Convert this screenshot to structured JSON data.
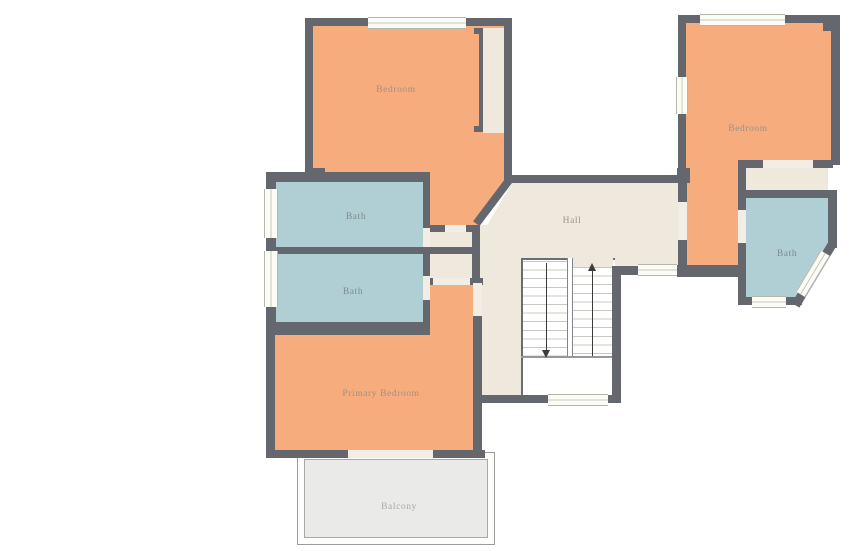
{
  "title": "Upper floor plan",
  "rooms": {
    "bedroom_top_left": {
      "label": "Bedroom",
      "fill": "#F7AC7E"
    },
    "bedroom_top_right": {
      "label": "Bedroom",
      "fill": "#F7AC7E"
    },
    "bath_upper_left": {
      "label": "Bath",
      "fill": "#B0CFD4"
    },
    "bath_lower_left": {
      "label": "Bath",
      "fill": "#B0CFD4"
    },
    "bath_right": {
      "label": "Bath",
      "fill": "#B0CFD4"
    },
    "hall": {
      "label": "Hall",
      "fill": "#EFE9DD"
    },
    "primary_bedroom": {
      "label": "Primary Bedroom",
      "fill": "#F7AC7E"
    },
    "balcony": {
      "label": "Balcony",
      "fill": "#EAEAE8"
    }
  },
  "stairs": {
    "flights": 2,
    "up_arrow": true,
    "down_arrow": true
  },
  "colors": {
    "wall": "#64676D",
    "window": "#FCFCF7",
    "door_opening": "#F2EEE5",
    "label_warm": "#9A9287",
    "label_cool": "#7C8C8F",
    "balcony_border": "#9B9B99"
  }
}
